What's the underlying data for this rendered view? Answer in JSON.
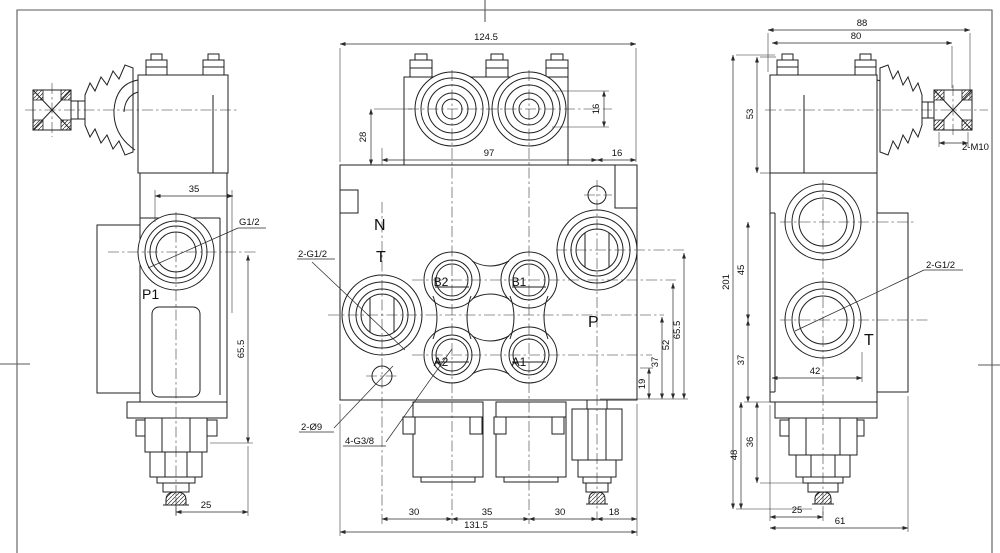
{
  "colors": {
    "line": "#1f1f1f",
    "frame": "#5a5a5a",
    "background": "#ffffff"
  },
  "views": {
    "left": {
      "dim_35": "35",
      "dim_65_5": "65.5",
      "dim_25": "25",
      "label_g12": "G1/2",
      "label_p1": "P1"
    },
    "middle": {
      "dim_124_5": "124.5",
      "dim_28": "28",
      "dim_16_top": "16",
      "dim_97": "97",
      "dim_16_right": "16",
      "dim_19": "19",
      "dim_37": "37",
      "dim_52": "52",
      "dim_65_5": "65.5",
      "dim_30_left": "30",
      "dim_35": "35",
      "dim_30_right": "30",
      "dim_18": "18",
      "dim_131_5": "131.5",
      "label_n": "N",
      "label_t": "T",
      "label_b2": "B2",
      "label_b1": "B1",
      "label_a2": "A2",
      "label_a1": "A1",
      "label_p": "P",
      "callout_2g12": "2-G1/2",
      "callout_2d9": "2-Ø9",
      "callout_4g38": "4-G3/8"
    },
    "right": {
      "dim_88": "88",
      "dim_80": "80",
      "dim_53": "53",
      "dim_201": "201",
      "dim_45": "45",
      "dim_37": "37",
      "dim_42": "42",
      "dim_48": "48",
      "dim_36": "36",
      "dim_25": "25",
      "dim_61": "61",
      "callout_2m10": "2-M10",
      "callout_2g12": "2-G1/2",
      "label_t": "T"
    }
  }
}
